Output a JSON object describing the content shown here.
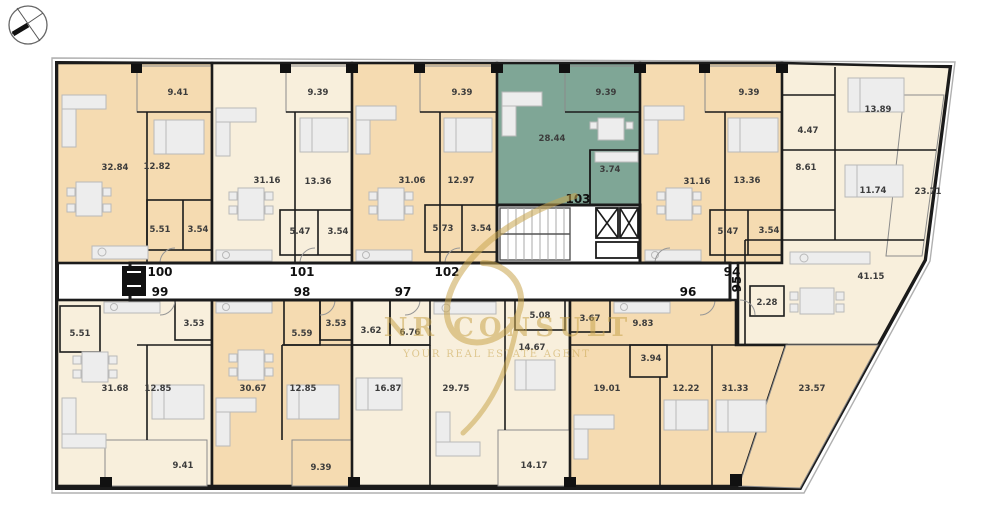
{
  "plan": {
    "watermark": {
      "brand": "NR CONSULT",
      "tagline": "YOUR REAL ESTATE AGENT"
    },
    "colors": {
      "tan": "#f5dbb1",
      "cream": "#f8efdc",
      "teal": "#7fa696",
      "white": "#ffffff",
      "gold": "#c9a54e",
      "wall": "#1b1b1b"
    },
    "units": {
      "u100": {
        "label": "100",
        "areas": {
          "living": "32.84",
          "bedroom": "12.82",
          "bath": "5.51",
          "wc": "3.54",
          "balcony": "9.41"
        }
      },
      "u101": {
        "label": "101",
        "areas": {
          "living": "31.16",
          "bedroom": "13.36",
          "bath": "5.47",
          "wc": "3.54",
          "balcony": "9.39"
        }
      },
      "u102": {
        "label": "102",
        "areas": {
          "living": "31.06",
          "bedroom": "12.97",
          "bath": "5.73",
          "wc": "3.54",
          "balcony": "9.39"
        }
      },
      "u103": {
        "label": "103",
        "areas": {
          "living": "28.44",
          "bath": "3.74",
          "balcony": "9.39"
        }
      },
      "u94": {
        "label": "94",
        "areas": {
          "living": "31.16",
          "bedroom": "13.36",
          "bath": "5.47",
          "wc": "3.54",
          "balcony": "9.39"
        }
      },
      "u95": {
        "label": "95",
        "areas": {
          "bedroom1": "13.89",
          "bath": "4.47",
          "hall": "8.61",
          "bedroom2": "11.74",
          "living": "41.15",
          "wc": "2.28",
          "balcony": "23.71"
        }
      },
      "u99": {
        "label": "99",
        "areas": {
          "living": "31.68",
          "bedroom": "12.85",
          "bath": "5.51",
          "wc": "3.53",
          "balcony": "9.41"
        }
      },
      "u98": {
        "label": "98",
        "areas": {
          "living": "30.67",
          "bedroom": "12.85",
          "bath": "5.59",
          "wc": "3.53",
          "balcony": "9.39"
        }
      },
      "u97": {
        "label": "97",
        "areas": {
          "bath": "3.62",
          "hall": "6.76",
          "bedroom": "16.87",
          "living": "29.75",
          "bath2": "5.08",
          "room": "14.67",
          "terrace": "14.17"
        }
      },
      "u96": {
        "label": "96",
        "areas": {
          "bath": "3.67",
          "kitchen": "9.83",
          "wc": "3.94",
          "living": "19.01",
          "bedroom": "12.22",
          "room": "31.33",
          "terrace": "23.57"
        }
      }
    }
  }
}
